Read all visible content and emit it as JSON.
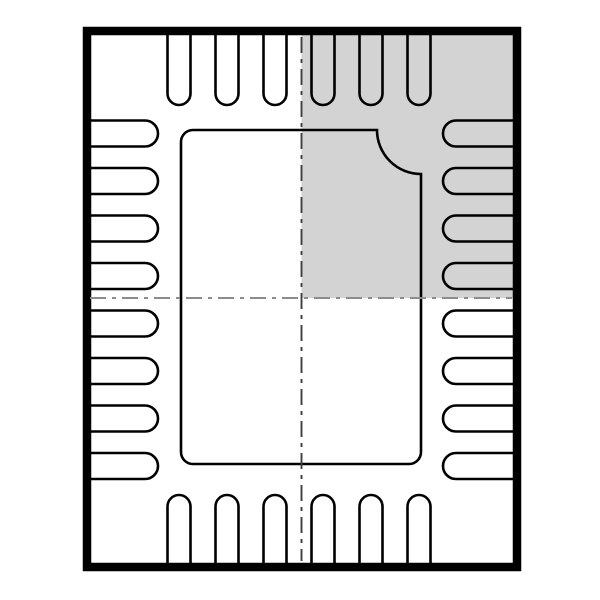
{
  "figure": {
    "kind": "ic-package-top-view",
    "pin_total": 28
  },
  "colors": {
    "background": "#ffffff",
    "line": "#000000",
    "shaded_quadrant": "#d3d3d3",
    "centerline_vertical": "#3f3f3f",
    "centerline_horizontal": "#8c8c8c"
  },
  "package": {
    "outline": {
      "x": 87,
      "y": 31,
      "width": 430,
      "height": 536
    },
    "border_thickness": 8.5
  },
  "shaded_quadrant": {
    "x": 301.5,
    "y": 35,
    "width": 211.5,
    "height": 263
  },
  "exposed_pad": {
    "left": 181,
    "top": 130,
    "right": 421,
    "bottom": 464,
    "corner_radius": 12,
    "notch_radius": 44,
    "stroke_width": 2.6
  },
  "pins": {
    "stroke_width": 2.6,
    "top": {
      "count": 6,
      "centers": [
        179,
        227,
        275,
        323,
        371,
        419
      ],
      "width": 23,
      "base": 35,
      "tip": 105
    },
    "bottom": {
      "count": 6,
      "centers": [
        179,
        227,
        275,
        323,
        371,
        419
      ],
      "width": 23,
      "base": 563,
      "tip": 495
    },
    "left": {
      "count": 8,
      "centers": [
        133.5,
        181,
        228.5,
        276,
        323.5,
        371,
        418.5,
        466
      ],
      "width": 26,
      "base": 91,
      "tip": 158
    },
    "right": {
      "count": 8,
      "centers": [
        133.5,
        181,
        228.5,
        276,
        323.5,
        371,
        418.5,
        466
      ],
      "width": 26,
      "base": 513,
      "tip": 443
    }
  },
  "centerlines": {
    "vertical": {
      "x": 301.5,
      "y1": 37,
      "y2": 561
    },
    "horizontal": {
      "y": 298,
      "x1": 90,
      "x2": 512
    },
    "dash_pattern": "16 6 4 6",
    "stroke_width": 1.9
  }
}
